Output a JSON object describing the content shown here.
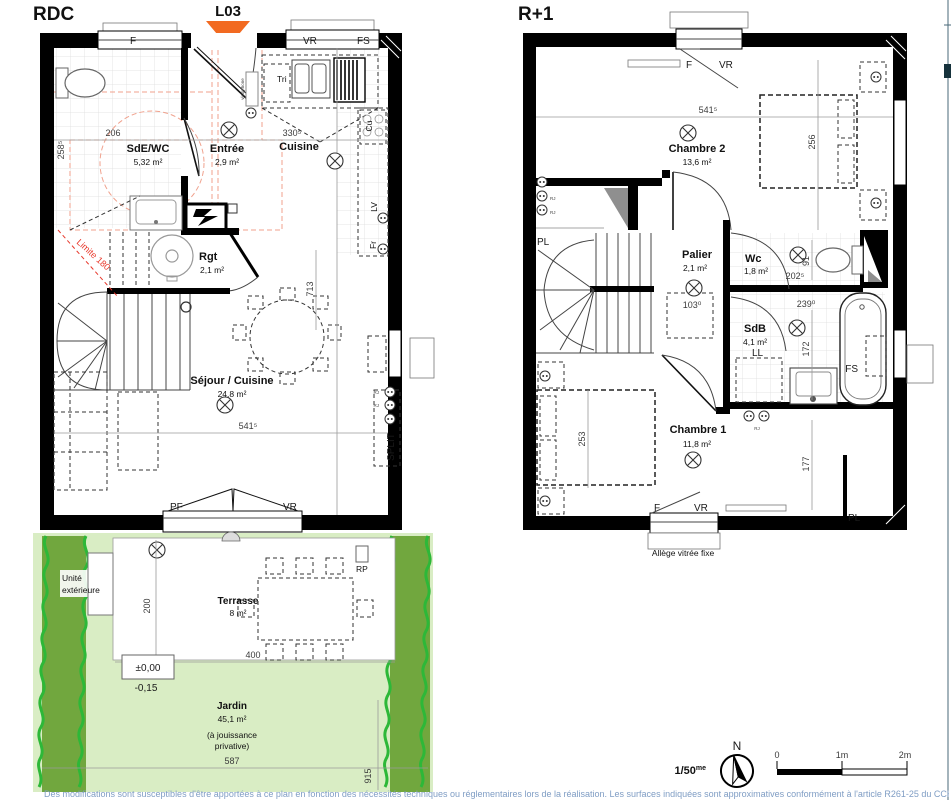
{
  "rdc": {
    "title": "RDC",
    "lot": "L03",
    "rooms": {
      "sde": {
        "name": "SdE/WC",
        "area": "5,32 m²"
      },
      "entree": {
        "name": "Entrée",
        "area": "2,9 m²"
      },
      "cuisine": {
        "name": "Cuisine"
      },
      "rgt": {
        "name": "Rgt",
        "area": "2,1 m²"
      },
      "sejour": {
        "name": "Séjour / Cuisine",
        "area": "24,8 m²"
      }
    },
    "labels": {
      "f": "F",
      "vr": "VR",
      "fs": "FS",
      "tri": "Tri",
      "visiophone": "visiophone",
      "cu": "Cu",
      "lv": "LV",
      "fr": "Fr",
      "split": "SPLIT",
      "pf": "PF",
      "vr_b": "VR",
      "limite": "Limite 180",
      "rj": "RJ"
    },
    "dims": {
      "w206": "206",
      "h258": "258⁵",
      "w330": "330⁵",
      "w541": "541⁵",
      "h713": "713"
    }
  },
  "garden": {
    "unite1": "Unité",
    "unite2": "extérieure",
    "rp": "RP",
    "terrasse": {
      "name": "Terrasse",
      "area": "8 m²"
    },
    "jardin": {
      "name": "Jardin",
      "area": "45,1 m²",
      "note1": "(à jouissance",
      "note2": "privative)"
    },
    "dims": {
      "h200": "200",
      "w400": "400",
      "lvl0": "±0,00",
      "lvl15": "-0,15",
      "w587": "587",
      "h915": "915"
    }
  },
  "r1": {
    "title": "R+1",
    "allege": "Allège vitrée fixe",
    "rooms": {
      "ch2": {
        "name": "Chambre 2",
        "area": "13,6 m²"
      },
      "palier": {
        "name": "Palier",
        "area": "2,1 m²"
      },
      "wc": {
        "name": "Wc",
        "area": "1,8 m²"
      },
      "sdb": {
        "name": "SdB",
        "area": "4,1 m²"
      },
      "ch1": {
        "name": "Chambre 1",
        "area": "11,8 m²"
      }
    },
    "labels": {
      "f": "F",
      "vr": "VR",
      "pl": "PL",
      "ll": "LL",
      "fs": "FS",
      "rj": "RJ"
    },
    "dims": {
      "w541": "541⁵",
      "h256": "256",
      "w202": "202⁵",
      "h91": "91",
      "w103": "103⁰",
      "w239": "239⁰",
      "h172": "172",
      "h253": "253",
      "h177": "177"
    }
  },
  "legend": {
    "scale": "1/50",
    "scale_sup": "me",
    "north": "N",
    "t0": "0",
    "t1": "1m",
    "t2": "2m"
  },
  "footer": "Des modifications sont susceptibles d'être apportées à ce plan en fonction des nécessités techniques ou réglementaires lors de la réalisation. Les surfaces indiquées sont approximatives conformément à l'article R261-25 du CCH",
  "colors": {
    "accent_orange": "#f26a21",
    "garden_green": "#d9edc4",
    "hedge_green": "#71a73e",
    "hedge_stroke": "#2db838",
    "limit_red": "#e8382b",
    "footer_blue": "#7f9dc4"
  }
}
